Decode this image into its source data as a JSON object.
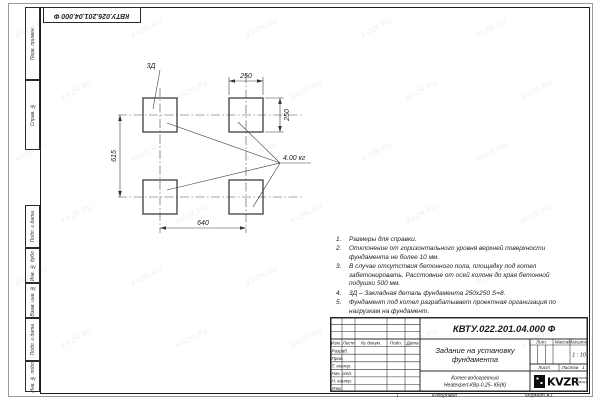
{
  "watermark": "KVZR.RU",
  "corner_stamp": "КВТУ.026.201.04.000 Ф",
  "margin": {
    "top": [
      "Перв. примен.",
      "Справ. №"
    ],
    "bottom": [
      "Подп. и дата",
      "Инв. № дубл.",
      "Взам. инв. №",
      "Подп. и дата",
      "Инв. № подл."
    ]
  },
  "plan": {
    "detail_label": "3Д",
    "weight_label": "4.00 кг",
    "dim_top": "250",
    "dim_right": "250",
    "dim_left": "615",
    "dim_bottom": "640"
  },
  "notes": [
    {
      "n": "1.",
      "text": "Размеры для справки."
    },
    {
      "n": "2.",
      "text": "Отклонение от горизонтального уровня верхней поверхности фундамента не более 10 мм."
    },
    {
      "n": "3.",
      "text": "В случае отсутствия бетонного пола, площадку под котел забетонировать. Расстояние от осей колонн до края бетонной подушки 500 мм."
    },
    {
      "n": "4.",
      "text": "3Д – Закладная деталь фундамента 250х250 S=8."
    },
    {
      "n": "5.",
      "text": "Фундамент под котел разрабатывает проектная организация по нагрузкам на фундамент."
    }
  ],
  "title_block": {
    "doc_number": "КВТУ.022.201.04.000 Ф",
    "title_line1": "Задание на установку",
    "title_line2": "фундамента",
    "product_line1": "Котел водогрейный",
    "product_line2": "Heatexpert-КВр-0,25- КБ(К)",
    "col_izm": "Изм.",
    "col_list": "Лист",
    "col_docnum": "№ докум.",
    "col_podp": "Подп.",
    "col_data": "Дата",
    "row_razrab": "Разраб.",
    "row_prov": "Пров.",
    "row_tkontr": "Т. контр.",
    "row_nachotd": "Нач. отд.",
    "row_nkontr": "Н. контр.",
    "row_utv": "Утв.",
    "lit_label": "Лит.",
    "mass_label": "Масса",
    "scale_label": "Масштаб",
    "scale_value": "1 : 10",
    "sheet_label": "Лист",
    "sheets_label": "Листов",
    "sheets_value": "1",
    "logo_text": "KVZR",
    "logo_sub1": "КОТЕЛЬНЫЙ",
    "logo_sub2": "ЗАВОД РЭП"
  },
  "footer": {
    "mark": "1",
    "copied": "Копировал",
    "format": "Формат А3"
  },
  "colors": {
    "line": "#2b2b2b",
    "paper": "#ffffff"
  }
}
